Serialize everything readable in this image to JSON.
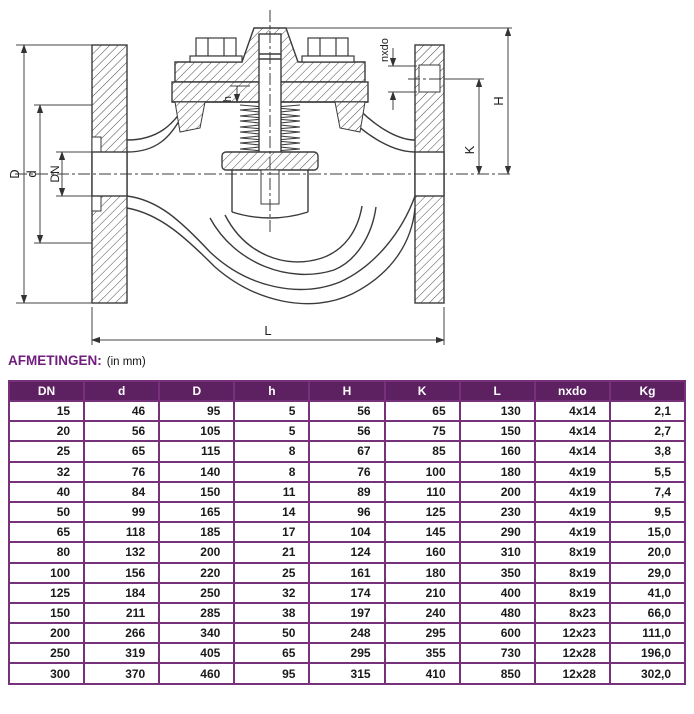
{
  "title": {
    "label": "AFMETINGEN:",
    "unit_note": "(in mm)"
  },
  "diagram": {
    "description": "cross-section technical drawing of a flanged spring-loaded lift check valve",
    "dim_labels": {
      "outer_diameter": "D",
      "raised_face": "d",
      "bore": "DN",
      "length": "L",
      "height": "H",
      "bolt_circle": "K",
      "lift": "h",
      "bolt_pattern": "nxdo"
    }
  },
  "table": {
    "headers": [
      "DN",
      "d",
      "D",
      "h",
      "H",
      "K",
      "L",
      "nxdo",
      "Kg"
    ],
    "rows": [
      [
        "15",
        "46",
        "95",
        "5",
        "56",
        "65",
        "130",
        "4x14",
        "2,1"
      ],
      [
        "20",
        "56",
        "105",
        "5",
        "56",
        "75",
        "150",
        "4x14",
        "2,7"
      ],
      [
        "25",
        "65",
        "115",
        "8",
        "67",
        "85",
        "160",
        "4x14",
        "3,8"
      ],
      [
        "32",
        "76",
        "140",
        "8",
        "76",
        "100",
        "180",
        "4x19",
        "5,5"
      ],
      [
        "40",
        "84",
        "150",
        "11",
        "89",
        "110",
        "200",
        "4x19",
        "7,4"
      ],
      [
        "50",
        "99",
        "165",
        "14",
        "96",
        "125",
        "230",
        "4x19",
        "9,5"
      ],
      [
        "65",
        "118",
        "185",
        "17",
        "104",
        "145",
        "290",
        "4x19",
        "15,0"
      ],
      [
        "80",
        "132",
        "200",
        "21",
        "124",
        "160",
        "310",
        "8x19",
        "20,0"
      ],
      [
        "100",
        "156",
        "220",
        "25",
        "161",
        "180",
        "350",
        "8x19",
        "29,0"
      ],
      [
        "125",
        "184",
        "250",
        "32",
        "174",
        "210",
        "400",
        "8x19",
        "41,0"
      ],
      [
        "150",
        "211",
        "285",
        "38",
        "197",
        "240",
        "480",
        "8x23",
        "66,0"
      ],
      [
        "200",
        "266",
        "340",
        "50",
        "248",
        "295",
        "600",
        "12x23",
        "111,0"
      ],
      [
        "250",
        "319",
        "405",
        "65",
        "295",
        "355",
        "730",
        "12x28",
        "196,0"
      ],
      [
        "300",
        "370",
        "460",
        "95",
        "315",
        "410",
        "850",
        "12x28",
        "302,0"
      ]
    ]
  },
  "colors": {
    "header_bg": "#5d2161",
    "table_border": "#77307a",
    "title_purple": "#701d7e",
    "line_color": "#3b3b3b",
    "text": "#1a1a1a"
  }
}
